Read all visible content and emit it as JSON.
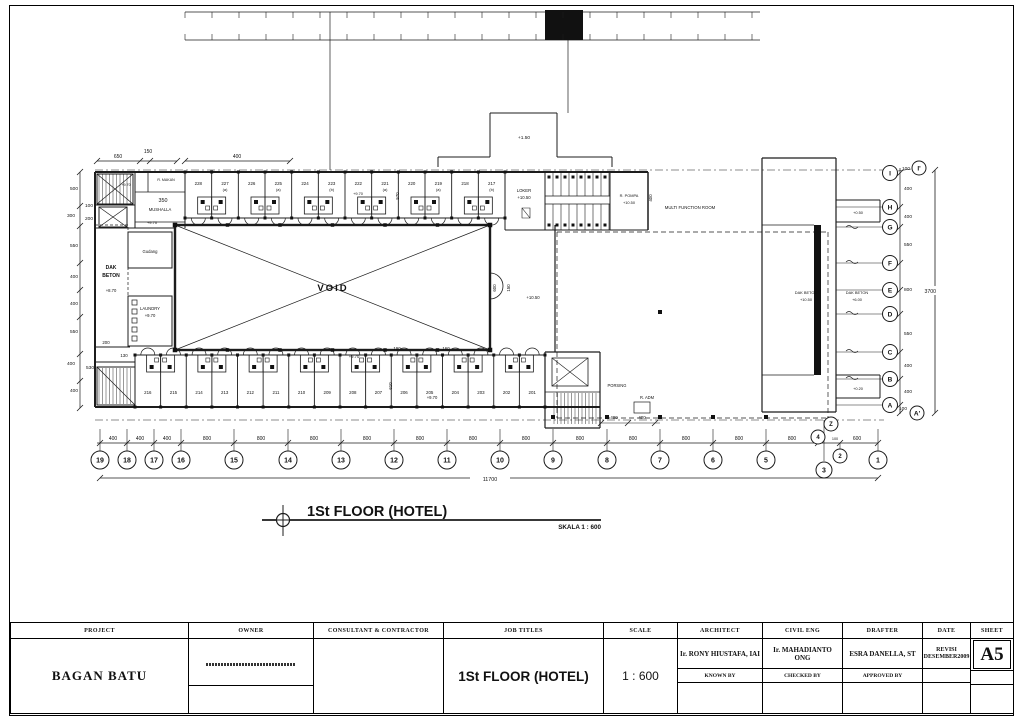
{
  "drawing": {
    "title": "1St FLOOR (HOTEL)",
    "scale_note": "SKALA 1 : 600"
  },
  "plan": {
    "rooms_top": [
      "228",
      "227 (a)",
      "226",
      "225 (a)",
      "224",
      "223 (b)",
      "222",
      "221 (a)",
      "220",
      "219 (a)",
      "218",
      "217 (b)"
    ],
    "rooms_bottom": [
      "216",
      "215",
      "214",
      "213",
      "212",
      "211",
      "210",
      "209",
      "208",
      "207",
      "206",
      "205",
      "204",
      "203",
      "202",
      "201"
    ],
    "labels": {
      "void": "VOID",
      "mushalla": "MUSHALLA",
      "mushalla_dim": "350",
      "r_makan": "R. MAKAN",
      "gudang": "Gudang",
      "laundry": "LAUNDRY",
      "laundry_level": "+9.70",
      "dak_left_1": "DAK",
      "dak_left_2": "BETON",
      "dak_left_level": "+8.70",
      "stair_level": "+9.70",
      "loker": "LOKER",
      "loker_level": "+10.50",
      "pompa": "R. POMPA",
      "pompa_level": "+10.50",
      "multi_function": "MULTI FUNCTION ROOM",
      "lobby_level": "+10.50",
      "corridor_level_1": "+9.70",
      "corridor_level_2": "+9.70",
      "corridor_level_3": "+9.70",
      "room_level": "+9.70",
      "canopy_level": "+1.50",
      "dak_right_1a": "DAK BETON",
      "dak_right_1b": "+10.50",
      "dak_right_2a": "DAK BETON",
      "dak_right_2b": "+6.00",
      "wing_top_level": "+0.50",
      "wing_bottom_level": "+0.20",
      "r_adm": "R. ADM",
      "porsing": "PORSING"
    },
    "grid": {
      "bottom_bubbles": [
        "19",
        "18",
        "17",
        "16",
        "15",
        "14",
        "13",
        "12",
        "11",
        "10",
        "9",
        "8",
        "7",
        "6",
        "5",
        "4",
        "Z",
        "3",
        "2",
        "1"
      ],
      "right_bubbles": [
        "I",
        "I'",
        "H",
        "G",
        "F",
        "E",
        "D",
        "C",
        "B",
        "A",
        "A'"
      ]
    },
    "dimensions": {
      "top_left": [
        "650",
        "150",
        "400"
      ],
      "left": [
        "500",
        "100",
        "300",
        "200",
        "550",
        "400",
        "400",
        "550",
        "400",
        "530",
        "400"
      ],
      "right": [
        "100",
        "400",
        "400",
        "550",
        "800",
        "550",
        "400",
        "400",
        "100"
      ],
      "right_total": "3700",
      "bottom": [
        "400",
        "400",
        "400",
        "800",
        "800",
        "800",
        "800",
        "800",
        "800",
        "800",
        "800",
        "800",
        "800",
        "800",
        "800",
        "150",
        "100",
        "600"
      ],
      "bottom_total": "11700",
      "misc": [
        "570",
        "190",
        "160",
        "610",
        "600",
        "150",
        "400",
        "200",
        "130",
        "400",
        "400"
      ]
    }
  },
  "title_block": {
    "project_label": "PROJECT",
    "project_value": "BAGAN BATU",
    "owner_label": "OWNER",
    "consultant_label": "CONSULTANT & CONTRACTOR",
    "job_label": "JOB TITLES",
    "job_value": "1St FLOOR (HOTEL)",
    "scale_label": "SCALE",
    "scale_value": "1 : 600",
    "architect_label": "ARCHITECT",
    "architect_value": "Ir. RONY HIUSTAFA, IAI",
    "known_by_label": "KNOWN BY",
    "civil_label": "CIVIL ENG",
    "civil_value": "Ir. MAHADIANTO ONG",
    "checked_by_label": "CHECKED BY",
    "drafter_label": "DRAFTER",
    "drafter_value": "ESRA DANELLA, ST",
    "approved_by_label": "APPROVED BY",
    "date_label": "DATE",
    "date_value_1": "REVISI",
    "date_value_2": "DESEMBER2009",
    "sheet_label": "SHEET",
    "sheet_value": "A5"
  }
}
